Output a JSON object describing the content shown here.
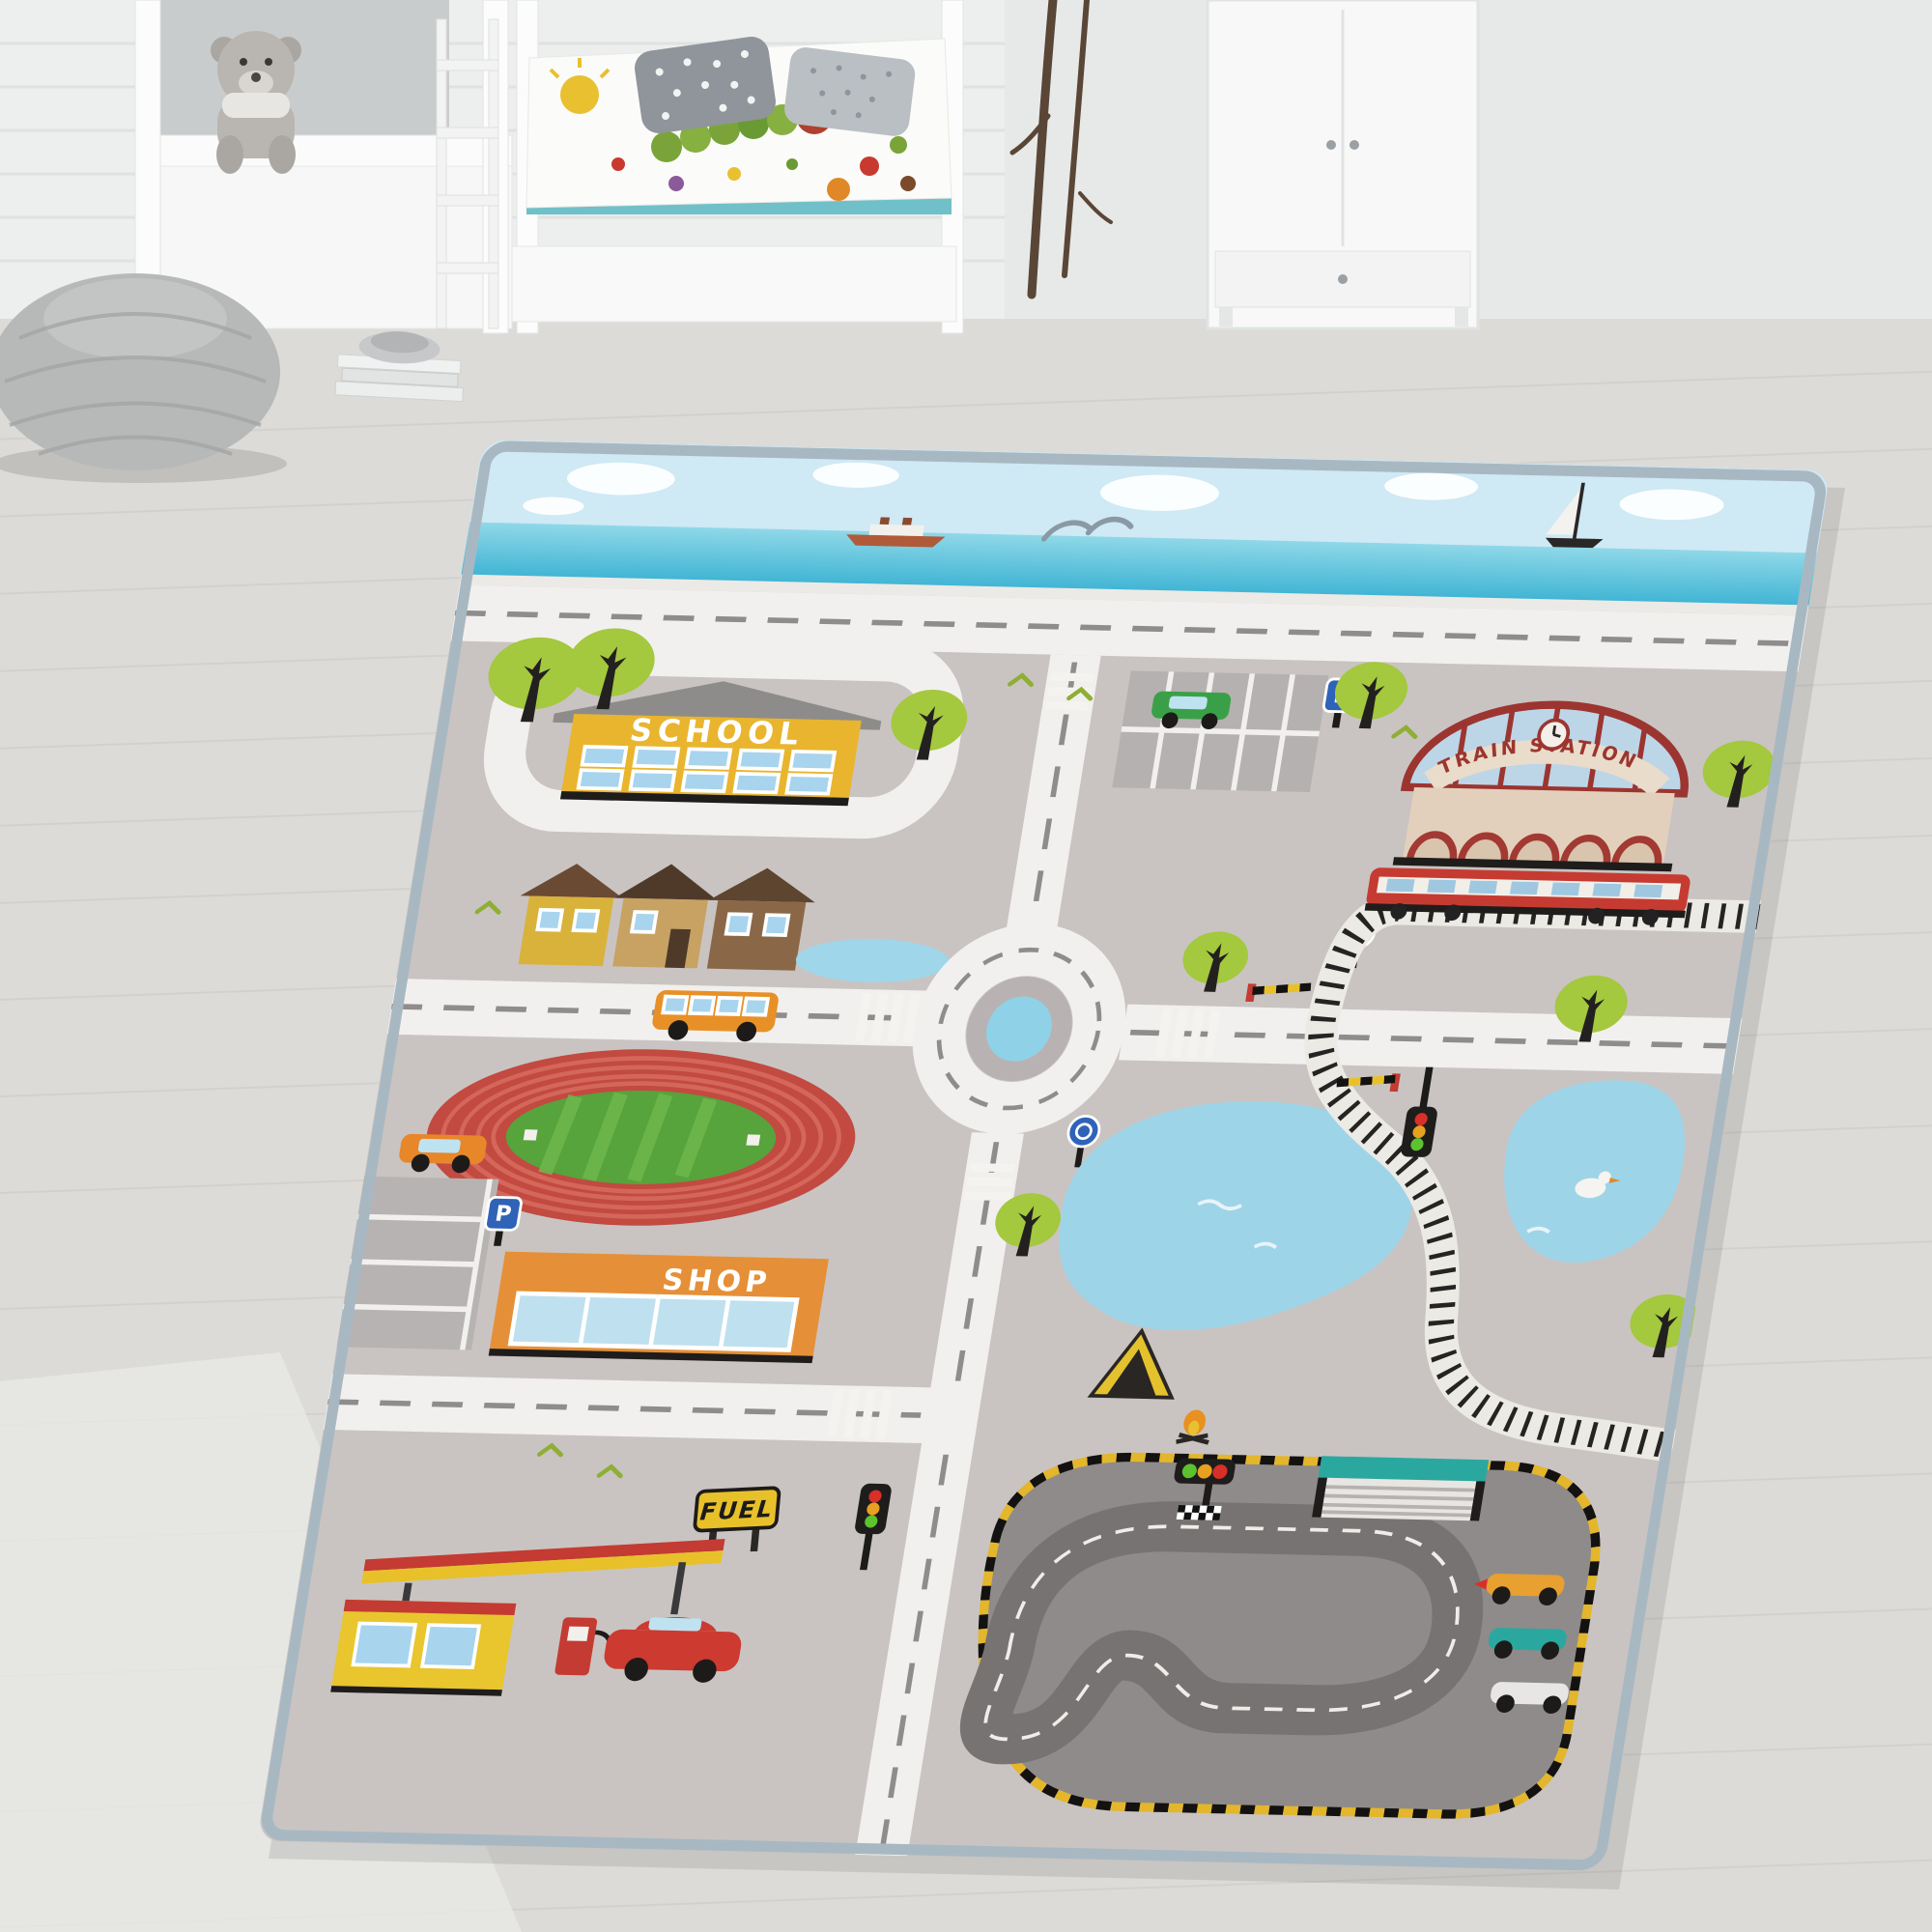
{
  "scene": {
    "description": "Photograph of a children's bedroom with a grey city street play rug on a light wooden floor",
    "room_items": [
      "white-bunk-bed",
      "teddy-bear",
      "caterpillar-duvet-bed",
      "polka-dot-pillows",
      "knitted-pouf",
      "book-stack",
      "decor-branches",
      "white-wardrobe",
      "wood-floor"
    ]
  },
  "rug": {
    "labels": {
      "school": "SCHOOL",
      "shop": "SHOP",
      "fuel": "FUEL",
      "train_station": "TRAIN STATION",
      "parking": "P"
    },
    "features": [
      "sky-band",
      "sea-band",
      "cruise-ship",
      "dolphins",
      "sailboat",
      "coast-road",
      "school-building",
      "top-parking-lot",
      "green-car",
      "train-station",
      "red-train",
      "railway-track",
      "level-crossing",
      "roundabout",
      "houses-row",
      "orange-bus",
      "stadium-running-track",
      "soccer-pitch",
      "shop-building",
      "left-parking-lot",
      "orange-car",
      "fuel-station",
      "fuel-pump",
      "red-car",
      "traffic-lights",
      "lake-left",
      "lake-right",
      "duck",
      "tent",
      "campfire",
      "race-track",
      "pit-garage",
      "start-lights",
      "checkered-line",
      "race-cars",
      "trees",
      "roundabout-signs",
      "zebra-crossings"
    ],
    "colors": {
      "rug_base": "#c9c4c2",
      "road": "#f2f0ee",
      "road_dash": "#8f8d8b",
      "sky": "#cfe9f5",
      "sea": "#49bcd8",
      "school_yellow": "#e9b52e",
      "shop_orange": "#e59038",
      "station_red": "#a23a33",
      "stadium_red": "#c24a40",
      "pitch_green": "#57a33c",
      "lake_blue": "#9ed4e8",
      "race_asphalt": "#8f8b8a",
      "curb_yellow": "#e3b62c",
      "fuel_yellow": "#e9c52e",
      "bus_orange": "#e89028",
      "car_red": "#cc3a30",
      "teal": "#2aa8a0",
      "sign_blue": "#2f63b8",
      "binding": "#a8b8c2"
    }
  }
}
